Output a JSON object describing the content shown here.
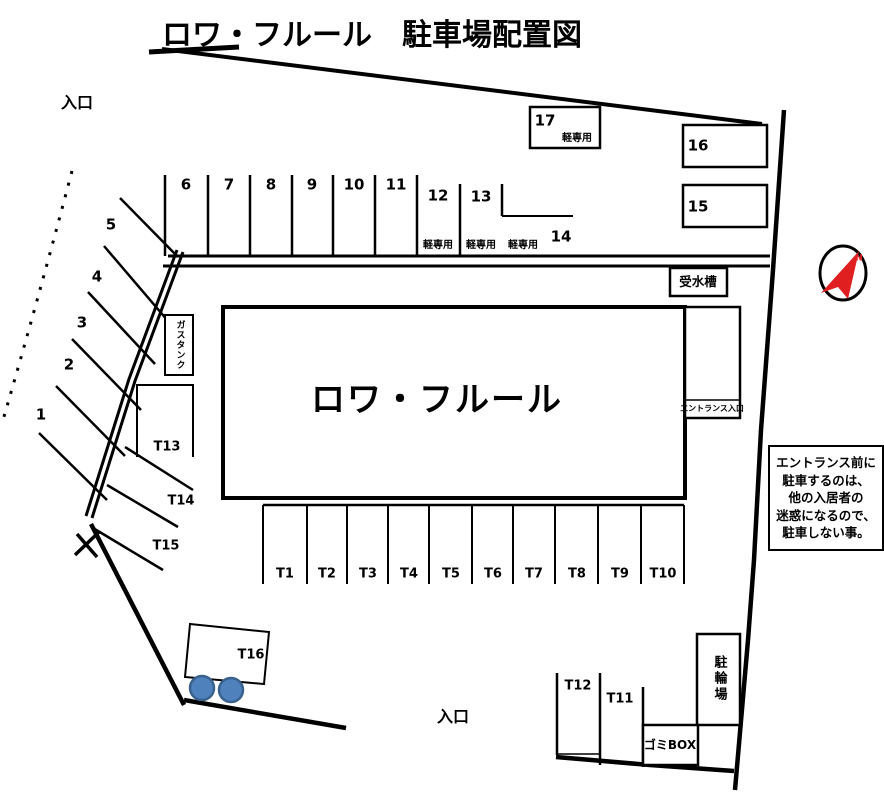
{
  "title": "ロワ・フルール　駐車場配置図",
  "building_name": "ロワ・フルール",
  "entrances": {
    "top": "入口",
    "bottom": "入口"
  },
  "facilities": {
    "water_tank": "受水槽",
    "gas_tank": "ガスタンク",
    "entrance_lobby": "エントランス入口",
    "bicycle_parking": "駐輪場",
    "garbage_box": "ゴミBOX"
  },
  "kei_only_label": "軽専用",
  "compass": {
    "north_label": "N"
  },
  "notice": {
    "lines": [
      "エントランス前に",
      "駐車するのは、",
      "他の入居者の",
      "迷惑になるので、",
      "駐車しない事。"
    ]
  },
  "spaces": {
    "diagonal": [
      "1",
      "2",
      "3",
      "4",
      "5"
    ],
    "row_top": [
      "6",
      "7",
      "8",
      "9",
      "10",
      "11",
      "12",
      "13",
      "14"
    ],
    "row_right": [
      "15",
      "16",
      "17"
    ],
    "t_row": [
      "T1",
      "T2",
      "T3",
      "T4",
      "T5",
      "T6",
      "T7",
      "T8",
      "T9",
      "T10"
    ],
    "t_side": [
      "T13",
      "T14",
      "T15"
    ],
    "t_bottom": [
      "T12",
      "T11"
    ],
    "t16": "T16"
  },
  "colors": {
    "line": "#000000",
    "parking_circle_fill": "#4f81bd",
    "parking_circle_stroke": "#38618c",
    "compass_red": "#e02020"
  }
}
